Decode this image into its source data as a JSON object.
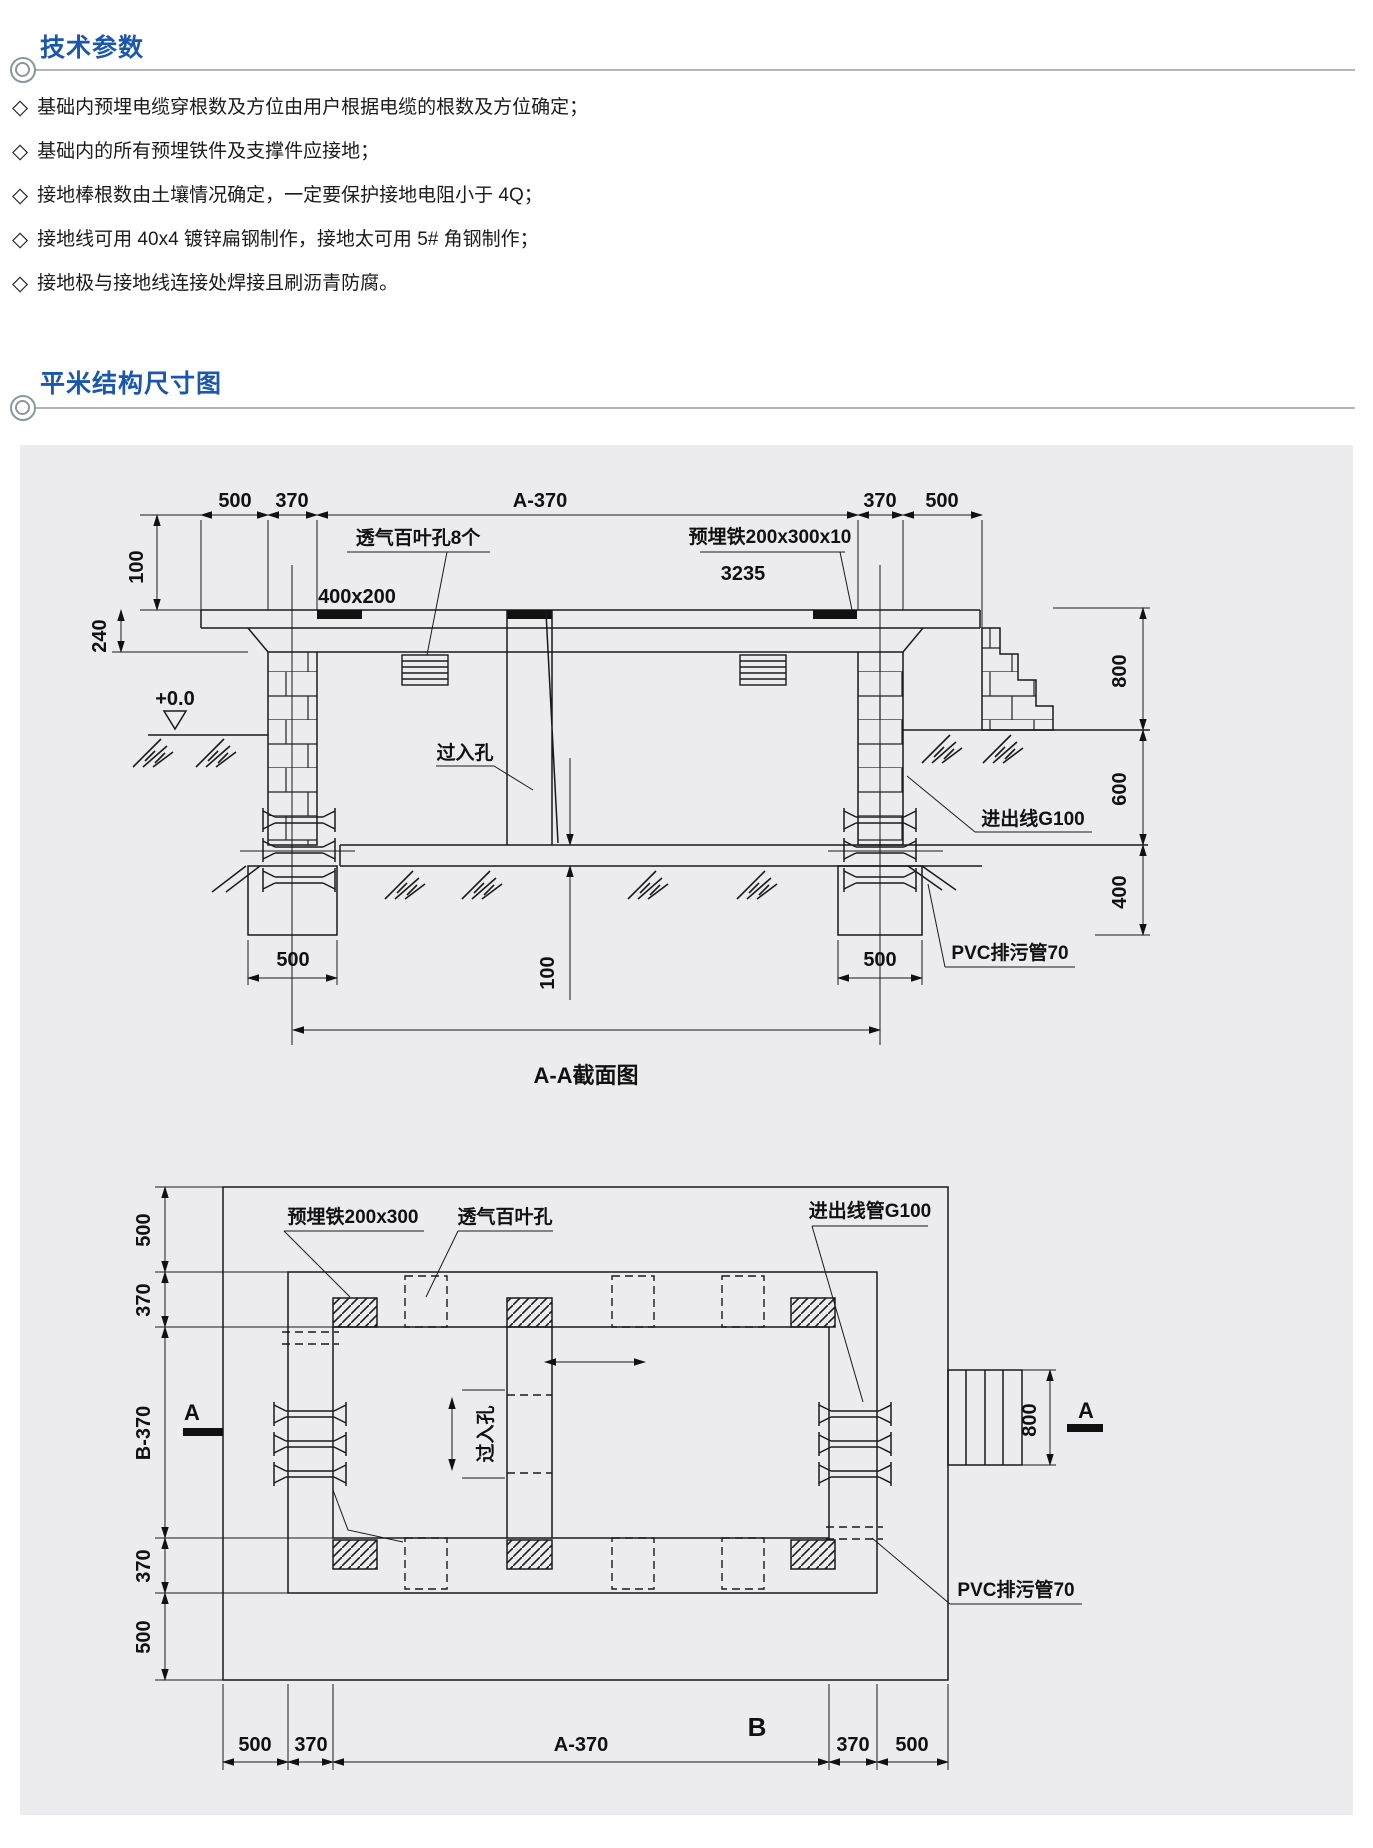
{
  "colors": {
    "accent": "#1b57aa",
    "panel_bg": "#ececee",
    "line": "#1a1a1a"
  },
  "sections": {
    "tech": {
      "title": "技术参数",
      "bullet_marker": "◇",
      "bullets": [
        "基础内预埋电缆穿根数及方位由用户根据电缆的根数及方位确定；",
        "基础内的所有预埋铁件及支撑件应接地；",
        "接地棒根数由土壤情况确定，一定要保护接地电阻小于 4Q；",
        "接地线可用 40x4 镀锌扁钢制作，接地太可用 5# 角钢制作；",
        "接地极与接地线连接处焊接且刷沥青防腐。"
      ]
    },
    "drawing": {
      "title": "平米结构尺寸图"
    }
  },
  "section_view": {
    "caption": "A-A截面图",
    "top_dims": [
      "500",
      "370",
      "A-370",
      "370",
      "500"
    ],
    "left_dims": [
      "100",
      "240"
    ],
    "right_dims": [
      "800",
      "600",
      "400"
    ],
    "footing_dims": [
      "500",
      "500"
    ],
    "floor_dim": "100",
    "labels": {
      "vent": "透气百叶孔8个",
      "iron": "预埋铁200x300x10",
      "num": "3235",
      "plate": "400x200",
      "level": "+0.0",
      "manhole": "过入孔",
      "inout": "进出线G100",
      "pvc": "PVC排污管70"
    }
  },
  "plan_view": {
    "left_dims": [
      "500",
      "370",
      "B-370",
      "370",
      "500"
    ],
    "bottom_dims": [
      "500",
      "370",
      "A-370",
      "370",
      "500"
    ],
    "right_dim": "800",
    "marker_a": "A",
    "labels": {
      "iron": "预埋铁200x300",
      "vent": "透气百叶孔",
      "conduit": "进出线管G100",
      "pvc": "PVC排污管70",
      "manhole": "过入孔",
      "b": "B"
    }
  }
}
